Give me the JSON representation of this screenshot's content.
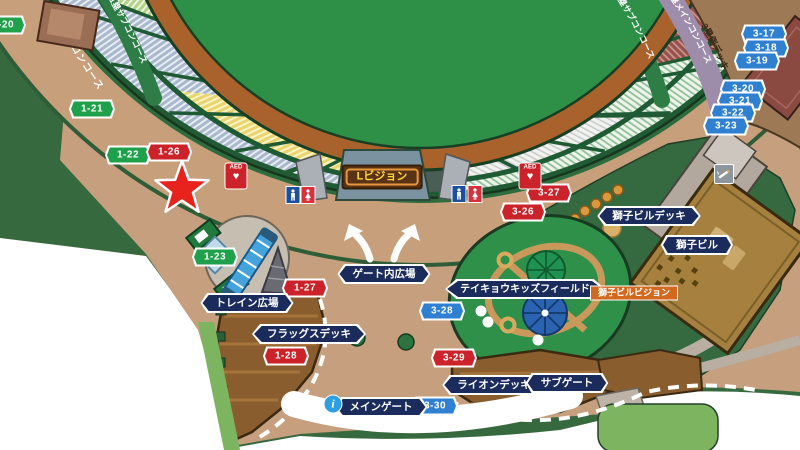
{
  "colors": {
    "park": "#37693f",
    "plaza": "#c69f7e",
    "field": "#2e9047",
    "track": "#a9622c",
    "navy": "#1a2b5c",
    "badge_green": "#1fa04a",
    "badge_red": "#cc2229",
    "badge_blue": "#2f80d0",
    "orange_sign": "#d2691e",
    "deck_brown": "#8a5d2e"
  },
  "stadium": {
    "vision_sign": "Lビジョン",
    "concourse_left_main": "1塁メインコンコース",
    "concourse_left_sub": "1塁サブコンコース",
    "concourse_right_sub": "3塁サブコンコース",
    "concourse_right_main": "3塁メインコンコース",
    "right_deck": "3塁側デッキ"
  },
  "areas": {
    "train_plaza": "トレイン広場",
    "flags_deck": "フラッグスデッキ",
    "gate_plaza": "ゲート内広場",
    "main_gate": "メインゲート",
    "lion_deck": "ライオンデッキ",
    "sub_gate": "サブゲート",
    "kids_field": "テイキョウキッズフィールド",
    "shishi_deck": "獅子ビルデッキ",
    "shishi_building": "獅子ビル",
    "shishi_vision": "獅子ビルビジョン"
  },
  "badges": [
    {
      "label": "1-20",
      "color": "green"
    },
    {
      "label": "1-21",
      "color": "green"
    },
    {
      "label": "1-22",
      "color": "green"
    },
    {
      "label": "1-26",
      "color": "red"
    },
    {
      "label": "1-23",
      "color": "green"
    },
    {
      "label": "1-27",
      "color": "red"
    },
    {
      "label": "1-28",
      "color": "red"
    },
    {
      "label": "3-26",
      "color": "red"
    },
    {
      "label": "3-27",
      "color": "red"
    },
    {
      "label": "3-28",
      "color": "blue"
    },
    {
      "label": "3-29",
      "color": "red"
    },
    {
      "label": "3-30",
      "color": "blue"
    },
    {
      "label": "3-17",
      "color": "blue"
    },
    {
      "label": "3-18",
      "color": "blue"
    },
    {
      "label": "3-19",
      "color": "blue"
    },
    {
      "label": "3-20",
      "color": "blue"
    },
    {
      "label": "3-21",
      "color": "blue"
    },
    {
      "label": "3-22",
      "color": "blue"
    },
    {
      "label": "3-23",
      "color": "blue"
    }
  ],
  "icons": {
    "aed_label": "AED",
    "info_label": "i"
  }
}
